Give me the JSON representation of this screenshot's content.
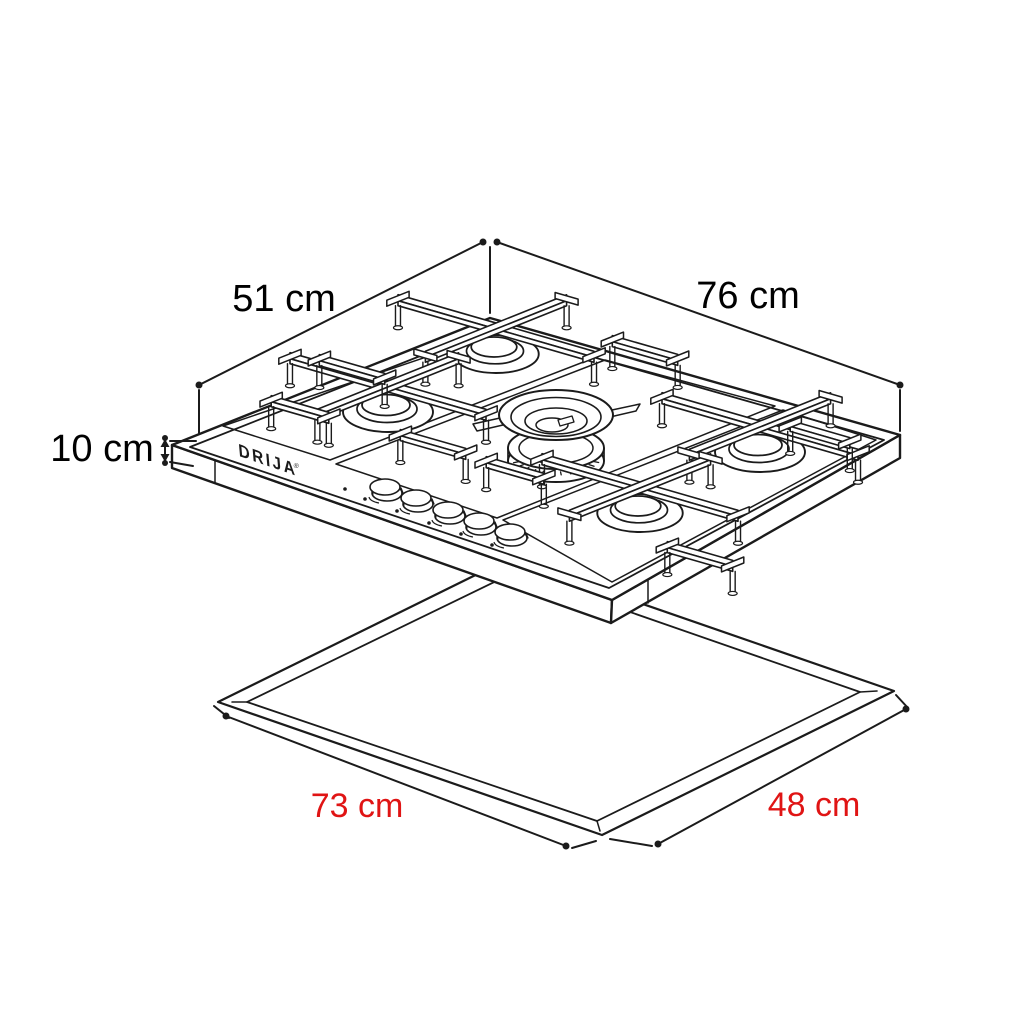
{
  "diagram": {
    "kind": "isometric-installation-drawing",
    "brand": {
      "logo_text": "DRIJA",
      "mark": "®"
    },
    "features": {
      "burners": 5,
      "control_knobs": 5
    },
    "labels": {
      "cooktop_depth": {
        "text": "51 cm",
        "value": 51,
        "unit": "cm",
        "color": "#000000"
      },
      "cooktop_width": {
        "text": "76 cm",
        "value": 76,
        "unit": "cm",
        "color": "#000000"
      },
      "cooktop_height": {
        "text": "10 cm",
        "value": 10,
        "unit": "cm",
        "color": "#000000"
      },
      "cutout_width": {
        "text": "73 cm",
        "value": 73,
        "unit": "cm",
        "color": "#e01414"
      },
      "cutout_depth": {
        "text": "48 cm",
        "value": 48,
        "unit": "cm",
        "color": "#e01414"
      }
    },
    "colors": {
      "ink": "#1b1b1b",
      "background": "#ffffff",
      "cutout_dimension_color": "#e01414"
    }
  }
}
